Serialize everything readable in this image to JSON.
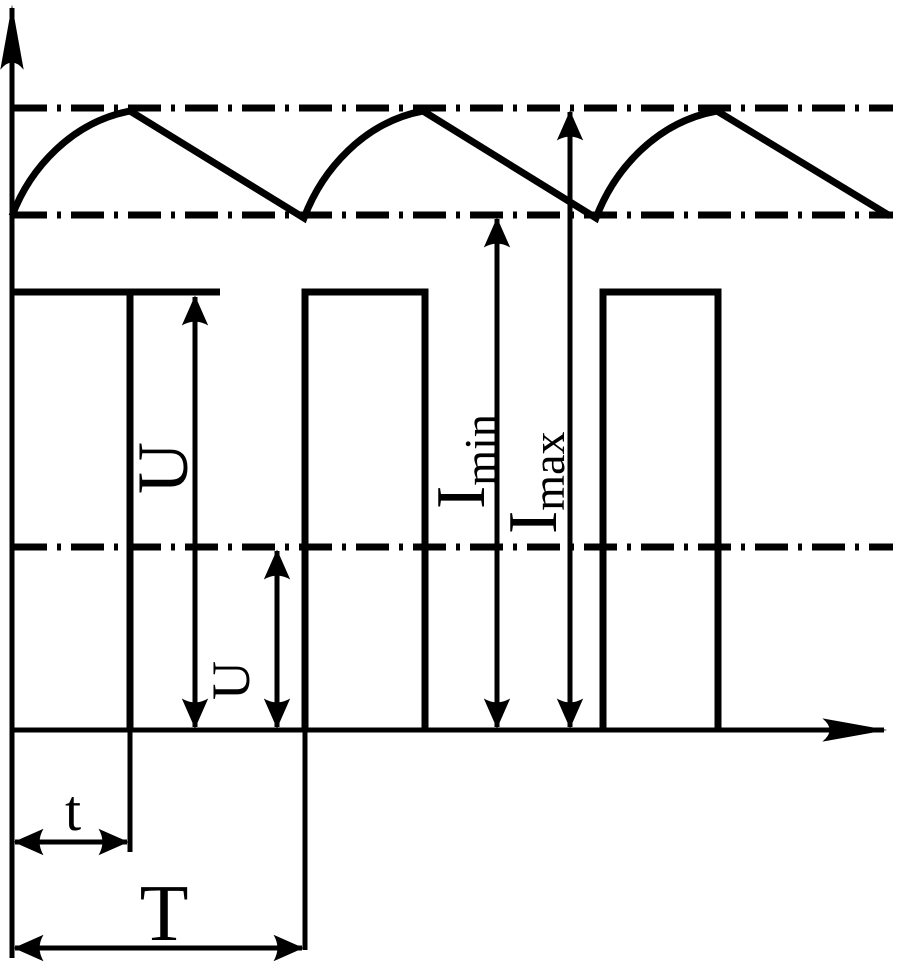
{
  "diagram": {
    "description": "Pulse waveform timing diagram with current ripple",
    "colors": {
      "background": "#ffffff",
      "line": "#000000"
    },
    "labels": {
      "pulse_amplitude": "U",
      "average_level": "U",
      "current_min_base": "I",
      "current_min_sub": "min",
      "current_max_base": "I",
      "current_max_sub": "max",
      "pulse_width": "t",
      "period": "T"
    }
  }
}
